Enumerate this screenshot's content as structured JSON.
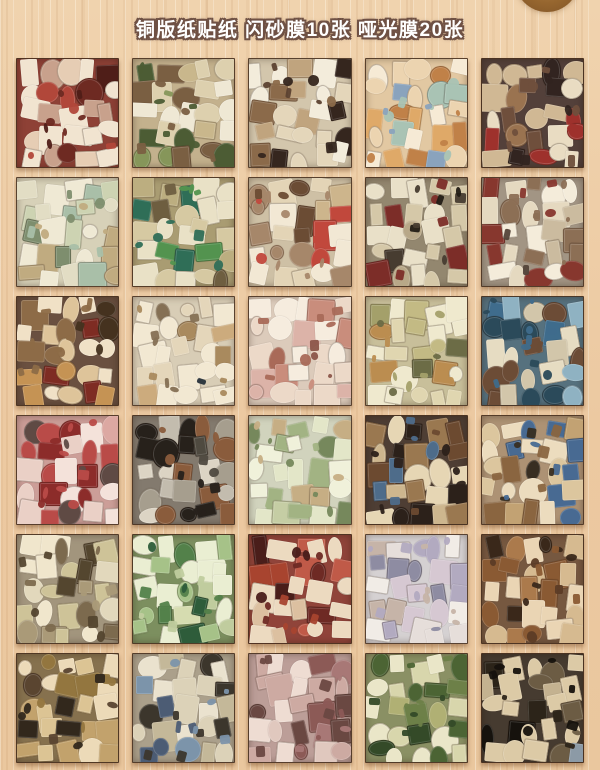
{
  "page": {
    "title": "铜版纸贴纸 闪砂膜10张 哑光膜20张",
    "title_color": "#ffffff",
    "title_outline_color": "#6f5144",
    "background_color": "#ecc9a1",
    "knot_color": "#96662f",
    "sheet_count": 30,
    "grid_rows": 6,
    "grid_cols": 5
  },
  "grid": {
    "tiles": [
      {
        "name": "strawberry-dessert-red",
        "base": "#8e4136",
        "palette": [
          "#f1e4d0",
          "#e6cdb4",
          "#c8a18c",
          "#b1473a",
          "#6e2a22",
          "#4f1e18"
        ]
      },
      {
        "name": "sandwich-tan-green",
        "base": "#c3b18d",
        "palette": [
          "#efe8d4",
          "#ddd0ae",
          "#c9b78c",
          "#86965a",
          "#7a5f42",
          "#4c5c34"
        ]
      },
      {
        "name": "coffee-cake-cream",
        "base": "#d3c6ac",
        "palette": [
          "#f3ecdb",
          "#e4d6ba",
          "#c0a47e",
          "#8b6a4a",
          "#5c4231",
          "#35261e"
        ]
      },
      {
        "name": "pastry-peach",
        "base": "#e2c8a2",
        "palette": [
          "#f6ead5",
          "#ecd4b0",
          "#dfa968",
          "#a9c3b4",
          "#c08148",
          "#8aa3bd"
        ]
      },
      {
        "name": "chocolate-dark-brown",
        "base": "#53403a",
        "palette": [
          "#e9dcc2",
          "#d0b894",
          "#9a7350",
          "#6f4f3c",
          "#9e312c",
          "#322420"
        ]
      },
      {
        "name": "pale-green-cream",
        "base": "#d7d1b8",
        "palette": [
          "#efe9d4",
          "#e2ddc4",
          "#cdd3b2",
          "#a9bfa8",
          "#c0ab80",
          "#7e8e6e"
        ]
      },
      {
        "name": "vegetable-green-tan",
        "base": "#a99c72",
        "palette": [
          "#e9e1c6",
          "#d6c9a2",
          "#bcae80",
          "#53934f",
          "#2f6e57",
          "#6e5e40"
        ]
      },
      {
        "name": "cake-cream-beige",
        "base": "#cec0a5",
        "palette": [
          "#f2e8d4",
          "#e3d4b6",
          "#cdb58c",
          "#a6876a",
          "#c1483c",
          "#6b4c34"
        ]
      },
      {
        "name": "black-cat-taupe",
        "base": "#93876f",
        "palette": [
          "#e9e0c8",
          "#d5c8a8",
          "#b8a888",
          "#7c2d28",
          "#473c30",
          "#231d16"
        ]
      },
      {
        "name": "white-cat-taupe",
        "base": "#a29584",
        "palette": [
          "#f4ecda",
          "#e5d9c0",
          "#cbbb9f",
          "#8c6f55",
          "#87372e",
          "#54453a"
        ]
      },
      {
        "name": "donut-dark-brown",
        "base": "#6a5040",
        "palette": [
          "#f0e1c6",
          "#dec49a",
          "#c59354",
          "#8d6b47",
          "#7e2c23",
          "#45321f"
        ]
      },
      {
        "name": "ice-cream-cream-navy",
        "base": "#d8cdb6",
        "palette": [
          "#f2e8d2",
          "#e4d6ba",
          "#ccab7d",
          "#a98a5e",
          "#27313b",
          "#857054"
        ]
      },
      {
        "name": "pink-cream-sweets",
        "base": "#dccbbb",
        "palette": [
          "#f6ecde",
          "#ecd9c8",
          "#dcb3a8",
          "#c98d7c",
          "#a96a58",
          "#8c564a"
        ]
      },
      {
        "name": "khaki-clothing",
        "base": "#c8bf9a",
        "palette": [
          "#efe9ce",
          "#e0d6b0",
          "#c3ba84",
          "#a4a06a",
          "#bb8d50",
          "#6c6c46"
        ]
      },
      {
        "name": "denim-blue-brown",
        "base": "#56717e",
        "palette": [
          "#e6dcc2",
          "#d2c6aa",
          "#8fb2c2",
          "#3f6c8c",
          "#6c4c36",
          "#2b4a5a"
        ]
      },
      {
        "name": "pink-red-sweets",
        "base": "#cc9e98",
        "palette": [
          "#f4e2da",
          "#ead0c6",
          "#dca8a2",
          "#b94b48",
          "#8c2c2a",
          "#5f4a44"
        ]
      },
      {
        "name": "gray-bear-items",
        "base": "#837a6e",
        "palette": [
          "#dcd4c4",
          "#c3bcae",
          "#a69e8e",
          "#8a5c3c",
          "#4f4a40",
          "#27211b"
        ]
      },
      {
        "name": "green-tea-cream",
        "base": "#d1d3bd",
        "palette": [
          "#f0f1da",
          "#e3e6c8",
          "#c5cda4",
          "#a2b383",
          "#c6ae84",
          "#76885c"
        ]
      },
      {
        "name": "vintage-dark-brown",
        "base": "#4e3e34",
        "palette": [
          "#e6d6b4",
          "#cdb68e",
          "#9a7850",
          "#4e6c8a",
          "#6c4a30",
          "#2c211a"
        ]
      },
      {
        "name": "tan-bags-blue",
        "base": "#ad9274",
        "palette": [
          "#ecdcbe",
          "#dcc69e",
          "#c2a273",
          "#486a92",
          "#8a6540",
          "#382e22"
        ]
      },
      {
        "name": "taupe-animals",
        "base": "#a2957d",
        "palette": [
          "#f0e6cc",
          "#e2d8bc",
          "#cec398",
          "#aa9a78",
          "#7c6a4e",
          "#54462f"
        ]
      },
      {
        "name": "green-garden",
        "base": "#7c8f5f",
        "palette": [
          "#eaeed2",
          "#d6dcb0",
          "#a6c288",
          "#53814a",
          "#2e5c3a",
          "#c0cc9e"
        ]
      },
      {
        "name": "maroon-plaid",
        "base": "#90443a",
        "palette": [
          "#ecdac0",
          "#dcc0a0",
          "#c05a48",
          "#6e2a24",
          "#4a1e1a",
          "#a8442f"
        ]
      },
      {
        "name": "lavender-cream",
        "base": "#d5d1d2",
        "palette": [
          "#f1ece6",
          "#e6deda",
          "#d6c8d2",
          "#b2aac0",
          "#c6b4a8",
          "#8e8ca2"
        ]
      },
      {
        "name": "chocolate-treats",
        "base": "#765840",
        "palette": [
          "#ead5b4",
          "#d6ba90",
          "#ab7a4c",
          "#8a5a33",
          "#5c3c26",
          "#3a281a"
        ]
      },
      {
        "name": "brown-bakery",
        "base": "#86714e",
        "palette": [
          "#ecdab8",
          "#dcc494",
          "#c2a26c",
          "#93763f",
          "#5a4530",
          "#32281c"
        ]
      },
      {
        "name": "tan-blue-clothing",
        "base": "#aba08b",
        "palette": [
          "#eae2ce",
          "#dcd2b8",
          "#c4b899",
          "#7c94aa",
          "#4c5c74",
          "#3c362c"
        ]
      },
      {
        "name": "mauve-pink-sweets",
        "base": "#bc9e98",
        "palette": [
          "#eedcd2",
          "#e0c8be",
          "#cdaaa2",
          "#a87876",
          "#8c5a56",
          "#6a4842"
        ]
      },
      {
        "name": "olive-bento-food",
        "base": "#8a9064",
        "palette": [
          "#eae6c8",
          "#d8d6ac",
          "#b0b074",
          "#6d8048",
          "#4c6434",
          "#344a28"
        ]
      },
      {
        "name": "dark-cats-food",
        "base": "#463b30",
        "palette": [
          "#dccaa6",
          "#c4b290",
          "#8c9aa6",
          "#6c5c44",
          "#2c2419",
          "#16120d"
        ]
      }
    ]
  }
}
